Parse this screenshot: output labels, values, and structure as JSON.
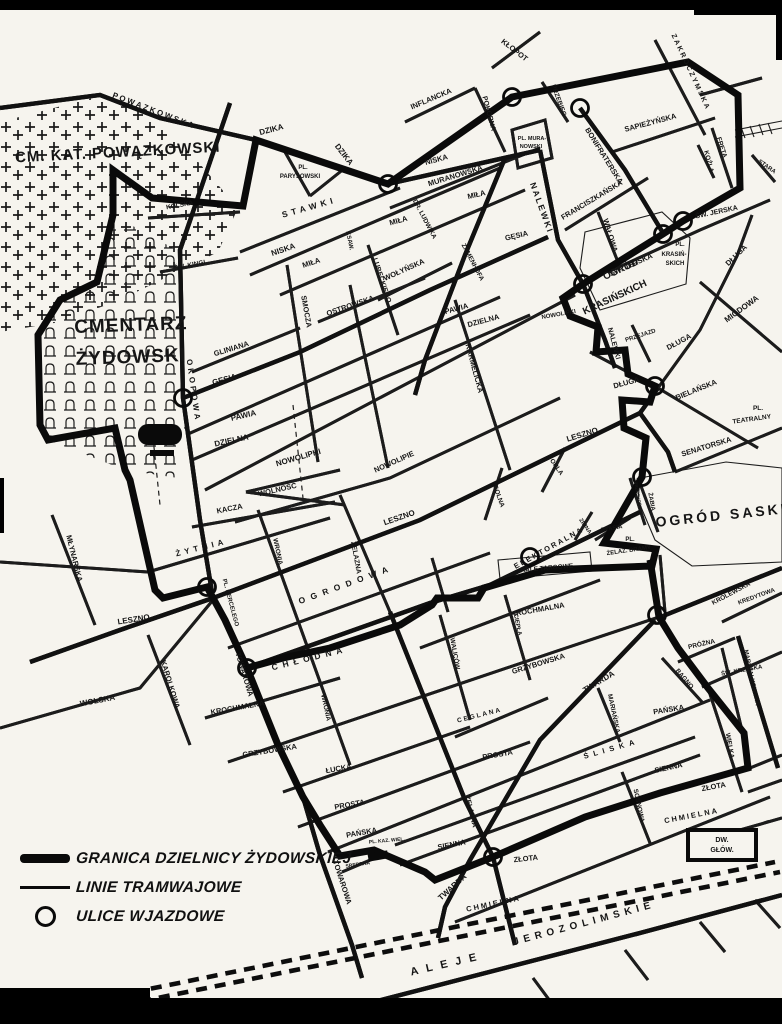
{
  "colors": {
    "paper": "#f6f4ee",
    "ink": "#151515",
    "boundary": "#0a0a0a"
  },
  "legend": {
    "items": [
      {
        "id": "boundary",
        "label": "GRANICA DZIELNICY ŻYDOWSKIEJ"
      },
      {
        "id": "tram",
        "label": "LINIE TRAMWAJOWE"
      },
      {
        "id": "entrance",
        "label": "ULICE WJAZDOWE"
      }
    ]
  },
  "map": {
    "entrances": [
      [
        388,
        184
      ],
      [
        512,
        97
      ],
      [
        580,
        108
      ],
      [
        683,
        221
      ],
      [
        663,
        234
      ],
      [
        583,
        284
      ],
      [
        655,
        386
      ],
      [
        183,
        398
      ],
      [
        642,
        477
      ],
      [
        530,
        557
      ],
      [
        207,
        587
      ],
      [
        247,
        668
      ],
      [
        657,
        615
      ],
      [
        493,
        857
      ]
    ],
    "labels": [
      {
        "cls": "big",
        "t": "CM. KAT. POWĄZKOWSKI",
        "x": 118,
        "y": 157,
        "r": -3,
        "s": 15,
        "ls": 1
      },
      {
        "cls": "big",
        "t": "CMENTARZ",
        "x": 131,
        "y": 331,
        "r": -2,
        "s": 19,
        "ls": 1
      },
      {
        "cls": "big",
        "t": "ŻYDOWSKI",
        "x": 131,
        "y": 363,
        "r": -2,
        "s": 19,
        "ls": 1
      },
      {
        "cls": "big",
        "t": "OGRÓD SASKI",
        "x": 722,
        "y": 520,
        "r": -6,
        "s": 14,
        "ls": 3
      },
      {
        "cls": "big",
        "t": "OGRÓD",
        "x": 622,
        "y": 272,
        "r": -25,
        "s": 10
      },
      {
        "cls": "big",
        "t": "KRASIŃSKICH",
        "x": 616,
        "y": 300,
        "r": -25,
        "s": 10
      },
      {
        "cls": "place",
        "t": "PL.",
        "x": 303,
        "y": 169,
        "s": 6
      },
      {
        "cls": "place",
        "t": "PARYSOWSKI",
        "x": 300,
        "y": 178,
        "s": 6
      },
      {
        "cls": "place",
        "t": "PL. MURA-",
        "x": 532,
        "y": 140,
        "s": 5.5
      },
      {
        "cls": "place",
        "t": "NOWSKI",
        "x": 531,
        "y": 148,
        "s": 5.5
      },
      {
        "cls": "place",
        "t": "PL.",
        "x": 680,
        "y": 246,
        "s": 6
      },
      {
        "cls": "place",
        "t": "KRASIŃ-",
        "x": 674,
        "y": 256,
        "s": 6
      },
      {
        "cls": "place",
        "t": "SKICH",
        "x": 675,
        "y": 265,
        "s": 6
      },
      {
        "cls": "place",
        "t": "PL.",
        "x": 758,
        "y": 410,
        "s": 6.5
      },
      {
        "cls": "place",
        "t": "TEATRALNY",
        "x": 752,
        "y": 421,
        "r": -8,
        "s": 6.5
      },
      {
        "cls": "place",
        "t": "PL.",
        "x": 630,
        "y": 541,
        "s": 6
      },
      {
        "cls": "place",
        "t": "ŻELAZ. BRAMY",
        "x": 629,
        "y": 552,
        "r": -8,
        "s": 6
      },
      {
        "cls": "place",
        "t": "HALE TARGOWE",
        "x": 547,
        "y": 570,
        "r": -5,
        "s": 6.5
      },
      {
        "cls": "place",
        "t": "PL. KAZ. WIEL.",
        "x": 387,
        "y": 842,
        "r": -5,
        "s": 5
      },
      {
        "cls": "place",
        "t": "PL. KERCELEGO",
        "x": 229,
        "y": 603,
        "r": 75,
        "s": 6
      },
      {
        "cls": "place",
        "t": "DW.",
        "x": 722,
        "y": 842,
        "s": 7
      },
      {
        "cls": "place",
        "t": "GŁÓW.",
        "x": 722,
        "y": 852,
        "s": 7
      },
      {
        "cls": "place",
        "t": "ALEJE",
        "x": 448,
        "y": 967,
        "r": -13,
        "s": 11,
        "ls": 8
      },
      {
        "cls": "place",
        "t": "JEROZOLIMSKIE",
        "x": 585,
        "y": 926,
        "r": -15,
        "s": 10,
        "ls": 5
      },
      {
        "cls": "street",
        "t": "POWĄZKOWSKA",
        "x": 153,
        "y": 113,
        "r": 21,
        "s": 8,
        "ls": 2
      },
      {
        "cls": "street",
        "t": "DZIKA",
        "x": 272,
        "y": 132,
        "r": -15,
        "s": 8
      },
      {
        "cls": "street",
        "t": "DZIKA",
        "x": 342,
        "y": 156,
        "r": 52,
        "s": 8
      },
      {
        "cls": "street",
        "t": "INFLANCKA",
        "x": 432,
        "y": 101,
        "r": -23,
        "s": 7.5
      },
      {
        "cls": "street",
        "t": "POKORNA",
        "x": 487,
        "y": 114,
        "r": 75,
        "s": 7
      },
      {
        "cls": "street",
        "t": "KŁOPOT",
        "x": 513,
        "y": 52,
        "r": 38,
        "s": 7.5
      },
      {
        "cls": "street",
        "t": "PRZEBIEG",
        "x": 557,
        "y": 101,
        "r": 70,
        "s": 6.5
      },
      {
        "cls": "street",
        "t": "ZAKROCZYMSKA",
        "x": 689,
        "y": 73,
        "r": 65,
        "s": 7,
        "ls": 2
      },
      {
        "cls": "street",
        "t": "SAPIEŻYŃSKA",
        "x": 651,
        "y": 125,
        "r": -15,
        "s": 7.5
      },
      {
        "cls": "street",
        "t": "FRETA",
        "x": 720,
        "y": 148,
        "r": 72,
        "s": 6.5
      },
      {
        "cls": "street",
        "t": "KOŹLA",
        "x": 707,
        "y": 162,
        "r": 75,
        "s": 6.5
      },
      {
        "cls": "street",
        "t": "STARA",
        "x": 766,
        "y": 168,
        "r": 35,
        "s": 6
      },
      {
        "cls": "street",
        "t": "BONIFRATERSKA",
        "x": 602,
        "y": 157,
        "r": 58,
        "s": 7.5
      },
      {
        "cls": "street",
        "t": "FRANCISZKAŃSKA",
        "x": 593,
        "y": 202,
        "r": -31,
        "s": 7.5
      },
      {
        "cls": "street",
        "t": "WAŁOWA",
        "x": 608,
        "y": 236,
        "r": 73,
        "s": 7.5
      },
      {
        "cls": "street",
        "t": "ŚW. JERSKA",
        "x": 632,
        "y": 267,
        "r": -24,
        "s": 7.5
      },
      {
        "cls": "street",
        "t": "ŚW. JERSKA",
        "x": 717,
        "y": 214,
        "r": -12,
        "s": 7
      },
      {
        "cls": "street",
        "t": "MIODOWA",
        "x": 743,
        "y": 311,
        "r": -36,
        "s": 8
      },
      {
        "cls": "street",
        "t": "DŁUGA",
        "x": 738,
        "y": 257,
        "r": -44,
        "s": 7.5
      },
      {
        "cls": "street",
        "t": "DŁUGA",
        "x": 680,
        "y": 344,
        "r": -28,
        "s": 7.5
      },
      {
        "cls": "street",
        "t": "DŁUGA",
        "x": 627,
        "y": 385,
        "r": -15,
        "s": 7.5
      },
      {
        "cls": "street",
        "t": "PRZEJAZD",
        "x": 641,
        "y": 337,
        "r": -18,
        "s": 6
      },
      {
        "cls": "street",
        "t": "NALEWKI",
        "x": 539,
        "y": 209,
        "r": 70,
        "s": 8.5,
        "ls": 2
      },
      {
        "cls": "street",
        "t": "NALEWKI",
        "x": 612,
        "y": 344,
        "r": 75,
        "s": 7
      },
      {
        "cls": "street",
        "t": "MURANOWSKA",
        "x": 456,
        "y": 178,
        "r": -17,
        "s": 7.5
      },
      {
        "cls": "street",
        "t": "NISKA",
        "x": 284,
        "y": 252,
        "r": -19,
        "s": 8
      },
      {
        "cls": "street",
        "t": "NISKA",
        "x": 437,
        "y": 162,
        "r": -15,
        "s": 7.5
      },
      {
        "cls": "street",
        "t": "STAWKI",
        "x": 310,
        "y": 210,
        "r": -16,
        "s": 8.5,
        "ls": 4
      },
      {
        "cls": "street",
        "t": "MIŁA",
        "x": 312,
        "y": 265,
        "r": -18,
        "s": 7.5
      },
      {
        "cls": "street",
        "t": "MIŁA",
        "x": 399,
        "y": 223,
        "r": -15,
        "s": 7.5
      },
      {
        "cls": "street",
        "t": "MIŁA",
        "x": 477,
        "y": 197,
        "r": -13,
        "s": 7.5
      },
      {
        "cls": "street",
        "t": "OSTROWSKA",
        "x": 351,
        "y": 308,
        "r": -19,
        "s": 7.5
      },
      {
        "cls": "street",
        "t": "WOŁYŃSKA",
        "x": 405,
        "y": 272,
        "r": -24,
        "s": 7.5
      },
      {
        "cls": "street",
        "t": "LUBECKIEGO",
        "x": 380,
        "y": 281,
        "r": 72,
        "s": 7
      },
      {
        "cls": "street",
        "t": "KSAW.",
        "x": 348,
        "y": 241,
        "r": 78,
        "s": 6
      },
      {
        "cls": "street",
        "t": "DR. LUDWIKA",
        "x": 423,
        "y": 220,
        "r": 62,
        "s": 6.5
      },
      {
        "cls": "street",
        "t": "ZAMENHOFA",
        "x": 471,
        "y": 263,
        "r": 62,
        "s": 6.5
      },
      {
        "cls": "street",
        "t": "GĘSIA",
        "x": 225,
        "y": 382,
        "r": -15,
        "s": 8
      },
      {
        "cls": "street",
        "t": "GĘSIA",
        "x": 517,
        "y": 238,
        "r": -13,
        "s": 7.5
      },
      {
        "cls": "street",
        "t": "GLINIANA",
        "x": 232,
        "y": 351,
        "r": -17,
        "s": 7.5
      },
      {
        "cls": "street",
        "t": "PAWIA",
        "x": 244,
        "y": 418,
        "r": -13,
        "s": 8
      },
      {
        "cls": "street",
        "t": "PAWIA",
        "x": 457,
        "y": 311,
        "r": -15,
        "s": 7.5
      },
      {
        "cls": "street",
        "t": "DZIELNA",
        "x": 232,
        "y": 443,
        "r": -12,
        "s": 8
      },
      {
        "cls": "street",
        "t": "DZIELNA",
        "x": 484,
        "y": 323,
        "r": -15,
        "s": 7.5
      },
      {
        "cls": "street",
        "t": "NOWOLIPKI",
        "x": 299,
        "y": 460,
        "r": -16,
        "s": 8
      },
      {
        "cls": "street",
        "t": "NOWOLIPKI",
        "x": 559,
        "y": 316,
        "r": -10,
        "s": 6
      },
      {
        "cls": "street",
        "t": "NOWOLIPIE",
        "x": 395,
        "y": 464,
        "r": -24,
        "s": 7.5
      },
      {
        "cls": "street",
        "t": "WOLNOŚĆ",
        "x": 278,
        "y": 492,
        "r": -13,
        "s": 7.5
      },
      {
        "cls": "street",
        "t": "KACZA",
        "x": 230,
        "y": 511,
        "r": -11,
        "s": 7.5
      },
      {
        "cls": "street",
        "t": "OKOPOWA",
        "x": 191,
        "y": 391,
        "r": 82,
        "s": 8,
        "ls": 3
      },
      {
        "cls": "street",
        "t": "SMOCZA",
        "x": 304,
        "y": 312,
        "r": 80,
        "s": 7.5
      },
      {
        "cls": "street",
        "t": "KARMELICKA",
        "x": 472,
        "y": 369,
        "r": 75,
        "s": 7.5
      },
      {
        "cls": "street",
        "t": "ŻYTNIA",
        "x": 202,
        "y": 550,
        "r": -14,
        "s": 8,
        "ls": 4
      },
      {
        "cls": "street",
        "t": "MŁYNARSKA",
        "x": 72,
        "y": 559,
        "r": 76,
        "s": 7.5
      },
      {
        "cls": "street",
        "t": "LESZNO",
        "x": 134,
        "y": 622,
        "r": -9,
        "s": 8
      },
      {
        "cls": "street",
        "t": "LESZNO",
        "x": 400,
        "y": 520,
        "r": -19,
        "s": 8
      },
      {
        "cls": "street",
        "t": "LESZNO",
        "x": 583,
        "y": 437,
        "r": -17,
        "s": 8
      },
      {
        "cls": "street",
        "t": "KAROLKOWA",
        "x": 168,
        "y": 685,
        "r": 73,
        "s": 7.5
      },
      {
        "cls": "street",
        "t": "WOLSKA",
        "x": 98,
        "y": 703,
        "r": -11,
        "s": 8
      },
      {
        "cls": "street",
        "t": "TOWAROWA",
        "x": 242,
        "y": 675,
        "r": 73,
        "s": 7.5
      },
      {
        "cls": "street",
        "t": "TOWAROWA",
        "x": 340,
        "y": 883,
        "r": 72,
        "s": 7.5
      },
      {
        "cls": "street",
        "t": "CHŁODNA",
        "x": 310,
        "y": 661,
        "r": -14,
        "s": 8.5,
        "ls": 5
      },
      {
        "cls": "street",
        "t": "KROCHMALNA",
        "x": 238,
        "y": 710,
        "r": -10,
        "s": 7.5
      },
      {
        "cls": "street",
        "t": "KROCHMALNA",
        "x": 538,
        "y": 612,
        "r": -10,
        "s": 7.5
      },
      {
        "cls": "street",
        "t": "GRZYBOWSKA",
        "x": 270,
        "y": 753,
        "r": -9,
        "s": 7.5
      },
      {
        "cls": "street",
        "t": "GRZYBOWSKA",
        "x": 539,
        "y": 666,
        "r": -17,
        "s": 7.5
      },
      {
        "cls": "street",
        "t": "ŁUCKA",
        "x": 339,
        "y": 771,
        "r": -10,
        "s": 7.5
      },
      {
        "cls": "street",
        "t": "PROSTA",
        "x": 350,
        "y": 807,
        "r": -10,
        "s": 7.5
      },
      {
        "cls": "street",
        "t": "PROSTA",
        "x": 498,
        "y": 757,
        "r": -10,
        "s": 7.5
      },
      {
        "cls": "street",
        "t": "PAŃSKA",
        "x": 362,
        "y": 835,
        "r": -10,
        "s": 7.5
      },
      {
        "cls": "street",
        "t": "PAŃSKA",
        "x": 669,
        "y": 712,
        "r": -9,
        "s": 7.5
      },
      {
        "cls": "street",
        "t": "ŚLISKA",
        "x": 612,
        "y": 751,
        "r": -16,
        "s": 7.5,
        "ls": 5
      },
      {
        "cls": "street",
        "t": "SIENNA",
        "x": 452,
        "y": 847,
        "r": -11,
        "s": 7.5
      },
      {
        "cls": "street",
        "t": "SIENNA",
        "x": 669,
        "y": 770,
        "r": -12,
        "s": 7.5
      },
      {
        "cls": "street",
        "t": "ZŁOTA",
        "x": 714,
        "y": 789,
        "r": -10,
        "s": 7.5
      },
      {
        "cls": "street",
        "t": "ZŁOTA",
        "x": 526,
        "y": 861,
        "r": -6,
        "s": 7.5
      },
      {
        "cls": "street",
        "t": "CHMIELNA",
        "x": 692,
        "y": 818,
        "r": -11,
        "s": 7.5,
        "ls": 2
      },
      {
        "cls": "street",
        "t": "CHMIELNA",
        "x": 494,
        "y": 906,
        "r": -12,
        "s": 7.5,
        "ls": 2
      },
      {
        "cls": "street",
        "t": "TWARDA",
        "x": 600,
        "y": 684,
        "r": -31,
        "s": 8
      },
      {
        "cls": "street",
        "t": "TWARDA",
        "x": 454,
        "y": 889,
        "r": -42,
        "s": 8
      },
      {
        "cls": "street",
        "t": "MARIAŃSKA",
        "x": 612,
        "y": 714,
        "r": 78,
        "s": 6.5
      },
      {
        "cls": "street",
        "t": "SOSNOWA",
        "x": 637,
        "y": 806,
        "r": 78,
        "s": 6.5
      },
      {
        "cls": "street",
        "t": "WIELKA",
        "x": 728,
        "y": 746,
        "r": 80,
        "s": 6.5
      },
      {
        "cls": "street",
        "t": "MARSZAŁKOWSKA",
        "x": 750,
        "y": 678,
        "r": 78,
        "s": 6
      },
      {
        "cls": "street",
        "t": "BAGNO",
        "x": 683,
        "y": 680,
        "r": 50,
        "s": 6.5
      },
      {
        "cls": "street",
        "t": "PRÓŻNA",
        "x": 702,
        "y": 646,
        "r": -13,
        "s": 6.5
      },
      {
        "cls": "street",
        "t": "ŚW. KRZYSKA",
        "x": 742,
        "y": 672,
        "r": -10,
        "s": 6
      },
      {
        "cls": "street",
        "t": "KRÓLEWSKA",
        "x": 732,
        "y": 595,
        "r": -28,
        "s": 6.5
      },
      {
        "cls": "street",
        "t": "KREDYTOWA",
        "x": 757,
        "y": 598,
        "r": -20,
        "s": 6
      },
      {
        "cls": "street",
        "t": "CIEPŁA",
        "x": 516,
        "y": 625,
        "r": 78,
        "s": 6
      },
      {
        "cls": "street",
        "t": "WALICÓW",
        "x": 453,
        "y": 654,
        "r": 80,
        "s": 6.5
      },
      {
        "cls": "street",
        "t": "ŻELAZNA",
        "x": 354,
        "y": 558,
        "r": 80,
        "s": 7
      },
      {
        "cls": "street",
        "t": "ŻELAZNA",
        "x": 469,
        "y": 812,
        "r": 76,
        "s": 7
      },
      {
        "cls": "street",
        "t": "WRONIA",
        "x": 276,
        "y": 552,
        "r": 78,
        "s": 6.5
      },
      {
        "cls": "street",
        "t": "WRONIA",
        "x": 324,
        "y": 708,
        "r": 78,
        "s": 6.5
      },
      {
        "cls": "street",
        "t": "OGRODOWA",
        "x": 347,
        "y": 587,
        "r": -20,
        "s": 8.5,
        "ls": 6
      },
      {
        "cls": "street",
        "t": "ELEKTORALNA",
        "x": 550,
        "y": 550,
        "r": -29,
        "s": 7.5,
        "ls": 2
      },
      {
        "cls": "street",
        "t": "SOLNA",
        "x": 497,
        "y": 497,
        "r": 70,
        "s": 6.5
      },
      {
        "cls": "street",
        "t": "ORLA",
        "x": 555,
        "y": 468,
        "r": 55,
        "s": 6.5
      },
      {
        "cls": "street",
        "t": "ZIMNA",
        "x": 584,
        "y": 527,
        "r": 55,
        "s": 5.5
      },
      {
        "cls": "street",
        "t": "PTASIA",
        "x": 612,
        "y": 530,
        "r": -10,
        "s": 6
      },
      {
        "cls": "street",
        "t": "ŻABIA",
        "x": 650,
        "y": 502,
        "r": 80,
        "s": 6
      },
      {
        "cls": "street",
        "t": "PRZECHODNIA",
        "x": 637,
        "y": 498,
        "r": 80,
        "s": 4.5
      },
      {
        "cls": "street",
        "t": "SENATORSKA",
        "x": 707,
        "y": 449,
        "r": -17,
        "s": 7.5
      },
      {
        "cls": "street",
        "t": "BIELAŃSKA",
        "x": 697,
        "y": 392,
        "r": -22,
        "s": 7.5
      },
      {
        "cls": "street",
        "t": "CEGLANA",
        "x": 480,
        "y": 717,
        "r": -14,
        "s": 6.5,
        "ls": 2
      },
      {
        "cls": "street",
        "t": "SREBRNA",
        "x": 358,
        "y": 866,
        "r": -8,
        "s": 5
      },
      {
        "cls": "street",
        "t": "ŚW. KINGI",
        "x": 190,
        "y": 267,
        "r": -11,
        "s": 6.5
      },
      {
        "cls": "street",
        "t": "KOLSKA",
        "x": 180,
        "y": 207,
        "r": -10,
        "s": 6.5
      }
    ]
  }
}
